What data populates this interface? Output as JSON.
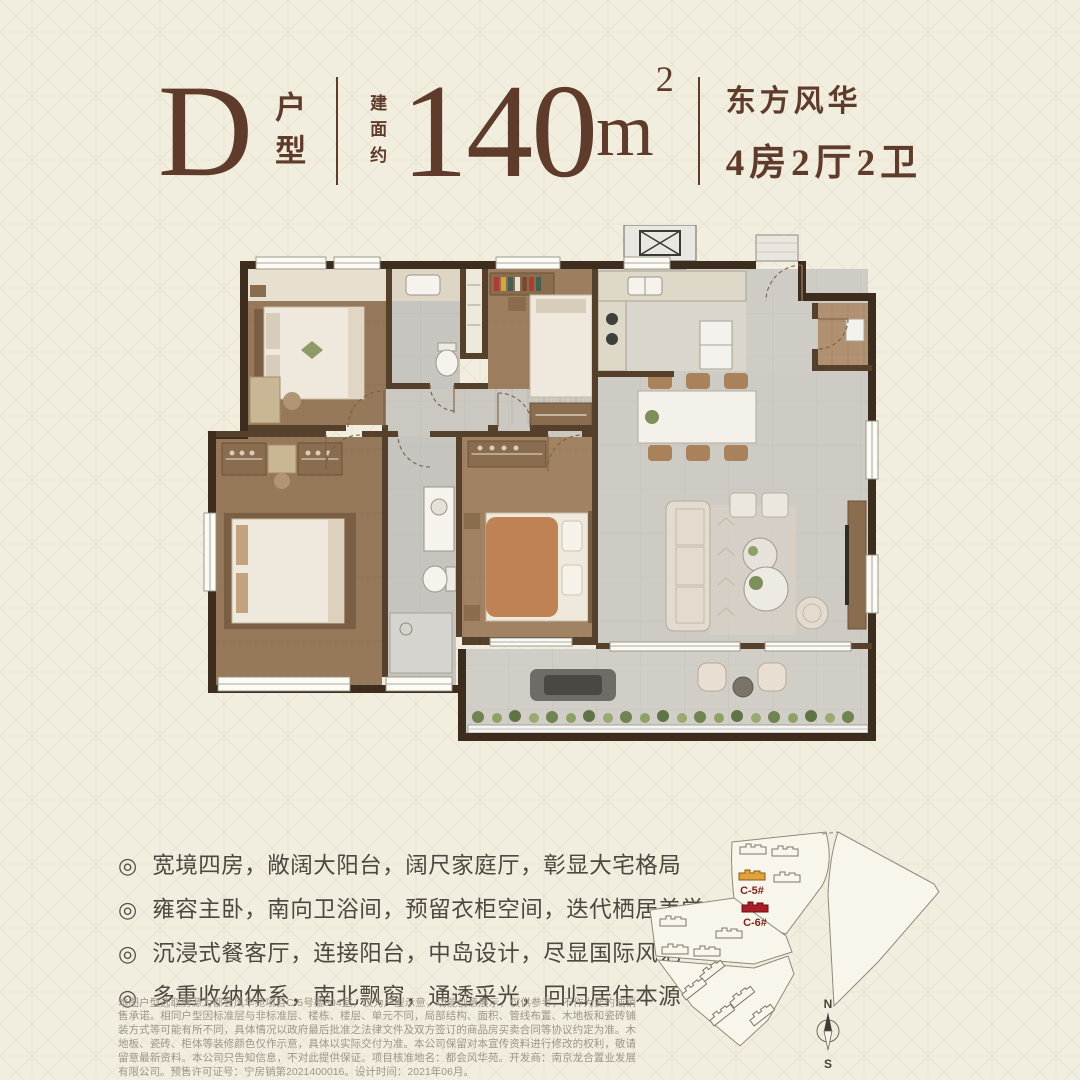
{
  "header": {
    "unit_letter": "D",
    "unit_suffix": "户型",
    "area_prefix": "建面约",
    "area_number": "140",
    "area_unit": "m",
    "area_sup": "2",
    "series_name": "东方风华",
    "room_config": "4房2厅2卫"
  },
  "features": {
    "bullet_icon": "◎",
    "items": [
      "宽境四房，敞阔大阳台，阔尺家庭厅，彰显大宅格局",
      "雍容主卧，南向卫浴间，预留衣柜空间，迭代栖居美学",
      "沉浸式餐客厅，连接阳台，中岛设计，尽显国际风范",
      "多重收纳体系，南北飘窗，通透采光，回归居住本源"
    ]
  },
  "disclaimer": "本图户型选取房源为都会风华苑项目C-5号楼804室，仅为户型示意，功能创意展示，仅供参考，不作为要约或销售承诺。相同户型因标准层与非标准层、楼栋、楼层、单元不同，局部结构、面积、管线布置、木地板和瓷砖铺装方式等可能有所不同，具体情况以政府最后批准之法律文件及双方签订的商品房买卖合同等协议约定为准。木地板、瓷砖、柜体等装修颜色仅作示意，具体以实际交付为准。本公司保留对本宣传资料进行修改的权利，敬请留意最新资料。本公司只告知信息，不对此提供保证。项目核准地名：都会风华苑。开发商：南京龙合置业发展有限公司。预售许可证号：宁房销第2021400016。设计时间：2021年06月。",
  "site_map": {
    "building_c5": "C-5#",
    "building_c6": "C-6#",
    "compass_north": "N",
    "compass_south": "S",
    "highlight_c5_color": "#e2a23a",
    "highlight_c6_color": "#a81e28"
  },
  "colors": {
    "background": "#f2eedf",
    "accent_brown": "#5e3b2a",
    "wall_dark": "#3d2d1e",
    "wall_medium": "#54402b",
    "wood_floor": "#96785a",
    "tile_gray": "#c7c5c0",
    "plant_green": "#708352"
  }
}
